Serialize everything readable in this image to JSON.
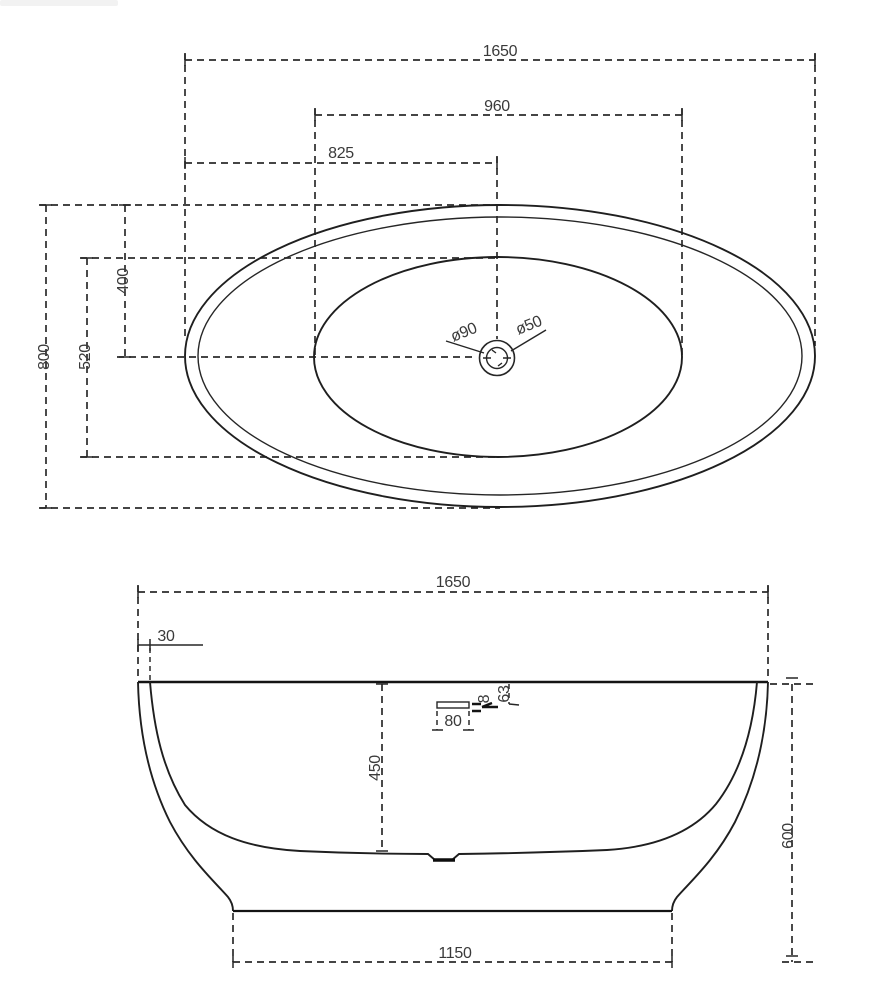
{
  "drawing": {
    "kind": "bathtub technical dimension drawing",
    "background": "#ffffff",
    "line_color": "#2b2b2b",
    "text_color": "#3a3a3a"
  },
  "top_view": {
    "length_overall": "1650",
    "basin_length": "960",
    "drain_center_offset": "825",
    "width_overall": "800",
    "basin_width": "520",
    "drain_center_offset_width": "400",
    "drain_outer_dia": "ø90",
    "drain_inner_dia": "ø50"
  },
  "front_view": {
    "length_overall": "1650",
    "rim_lip_width": "30",
    "inner_depth": "450",
    "overflow_width": "80",
    "overflow_height": "8",
    "overflow_top_offset": "63",
    "height_overall": "600",
    "base_length": "1150"
  }
}
